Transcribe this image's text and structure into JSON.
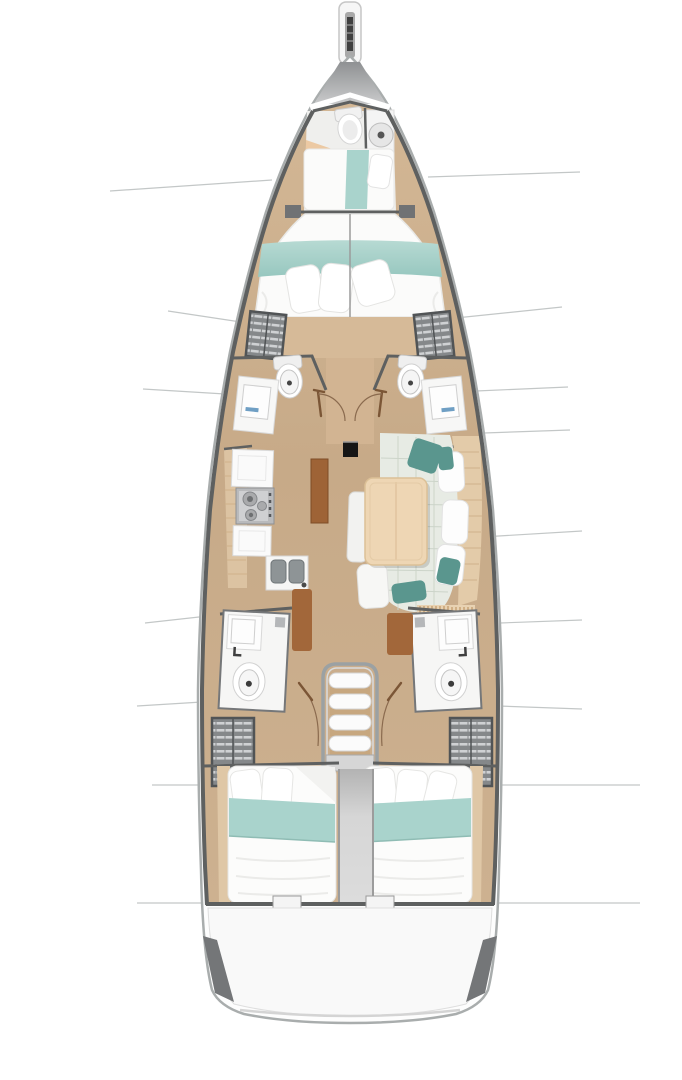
{
  "diagram": {
    "kind": "sailing-yacht-interior-floor-plan",
    "view": "top-down deck plan",
    "orientation": "bow-at-top-stern-at-bottom",
    "hull_symmetry_axis_x": 350
  },
  "palette": {
    "bg": "#ffffff",
    "hull_outline": "#a9adad",
    "deck_white": "#fcfcfc",
    "bulkhead": "#5e6060",
    "wood_floor": "#c9ac8b",
    "wood_floor_light": "#d6ba98",
    "shelf_wood": "#e0c8a6",
    "plank": "#cfb28a",
    "bed_white": "#fbfbfa",
    "blanket_teal": "#a9d3cc",
    "cushion_teal": "#5a968e",
    "sofa_sage": "#e7ebe4",
    "sofa_seam": "#ccd4c9",
    "furniture_white": "#f7f7f6",
    "appliance_steel": "#b9babc",
    "accent_brown": "#a2673a",
    "locker_dark": "#85888a",
    "locker_light": "#cfd1d3",
    "stair_grey": "#d6d6d6",
    "corridor_grey": "#cfcfcf",
    "transom_white": "#f9f9f9",
    "transom_wedge": "#747678",
    "mast_black": "#161616",
    "faucet_blue": "#6f9fc4",
    "leader": "#c3c7c7",
    "door_arc": "#8a6a4e",
    "door_leaf": "#7b5636"
  },
  "compartments": [
    {
      "id": "bowsprit",
      "name": "bowsprit-anchor-fitting",
      "fixtures": [
        "anchor-roller"
      ]
    },
    {
      "id": "bow-locker",
      "name": "foredeck-anchor-locker",
      "fixtures": []
    },
    {
      "id": "forward-head",
      "name": "forward-head-with-shower",
      "fixtures": [
        "toilet",
        "shower",
        "vanity-seat"
      ]
    },
    {
      "id": "forward-berth",
      "name": "forward-crew-berth",
      "fixtures": [
        "single-berth",
        "pillow",
        "teal-runner"
      ]
    },
    {
      "id": "owner-cabin",
      "name": "owner-cabin-v-berth",
      "fixtures": [
        "double-bed",
        "pillows",
        "teal-blanket",
        "wardrobe-port",
        "wardrobe-starboard"
      ]
    },
    {
      "id": "port-forward-head",
      "name": "port-forward-head",
      "fixtures": [
        "toilet",
        "washbasin",
        "door-swing"
      ]
    },
    {
      "id": "starboard-forward-head",
      "name": "starboard-forward-head",
      "fixtures": [
        "toilet",
        "washbasin",
        "door-swing"
      ]
    },
    {
      "id": "mast",
      "name": "mast-base",
      "fixtures": [
        "mast"
      ]
    },
    {
      "id": "galley",
      "name": "port-side-galley",
      "fixtures": [
        "worktop",
        "stove-two-burner",
        "worktop",
        "double-sink",
        "refrigerator-panel"
      ]
    },
    {
      "id": "salon",
      "name": "starboard-salon-dinette",
      "fixtures": [
        "dining-table",
        "u-shaped-sofa",
        "teal-cushions",
        "back-cushions",
        "side-shelf",
        "vent-grille"
      ]
    },
    {
      "id": "companionway",
      "name": "companionway-stairs",
      "fixtures": [
        "four-step-ladder",
        "landing-platform",
        "engine-box-corridor"
      ]
    },
    {
      "id": "port-aft-head",
      "name": "port-aft-head",
      "fixtures": [
        "washbasin",
        "toilet",
        "door-swing"
      ]
    },
    {
      "id": "starboard-aft-head",
      "name": "starboard-aft-head",
      "fixtures": [
        "washbasin",
        "toilet",
        "door-swing"
      ]
    },
    {
      "id": "port-aft-wardrobe",
      "name": "port-aft-wardrobe-locker",
      "fixtures": [
        "slatted-locker"
      ]
    },
    {
      "id": "starboard-aft-wardrobe",
      "name": "starboard-aft-wardrobe-locker",
      "fixtures": [
        "slatted-locker"
      ]
    },
    {
      "id": "port-aft-cabin",
      "name": "port-aft-double-cabin",
      "fixtures": [
        "double-bed",
        "pillows",
        "teal-blanket",
        "side-shelf"
      ]
    },
    {
      "id": "starboard-aft-cabin",
      "name": "starboard-aft-double-cabin",
      "fixtures": [
        "double-bed",
        "pillows",
        "teal-blanket",
        "side-shelf"
      ]
    },
    {
      "id": "transom",
      "name": "stern-transom-swim-platform",
      "fixtures": [
        "transom-lockers"
      ]
    }
  ],
  "annotations": {
    "leader_lines_left_y": [
      185,
      318,
      391,
      620,
      704,
      785,
      903
    ],
    "leader_lines_right_y": [
      175,
      313,
      389,
      432,
      535,
      622,
      707,
      785,
      903
    ]
  }
}
